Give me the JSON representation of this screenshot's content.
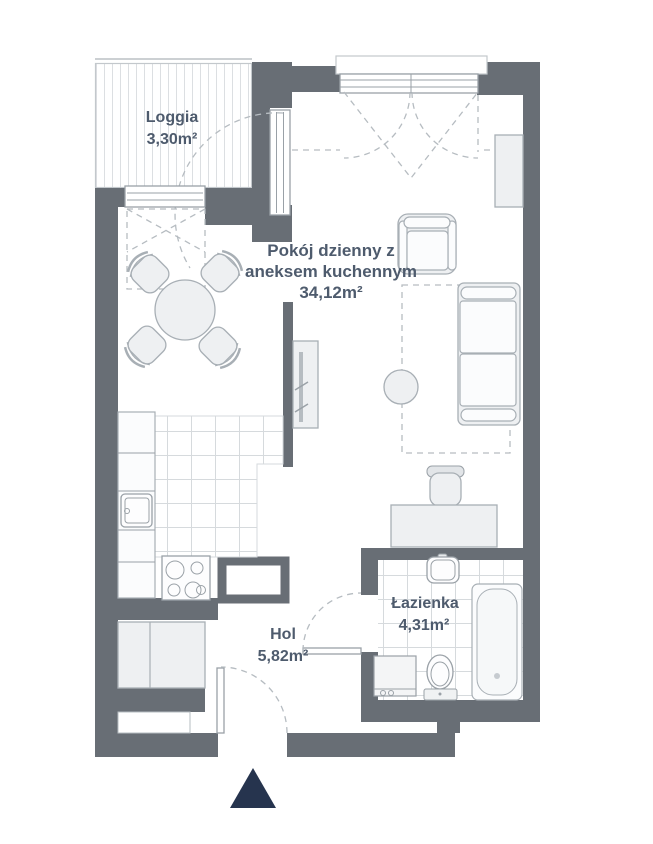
{
  "plan": {
    "rooms": [
      {
        "name": "Loggia",
        "area": "3,30m²"
      },
      {
        "name": "Pokój dzienny z aneksem kuchennym",
        "name_lines": [
          "Pokój dzienny z",
          "aneksem kuchennym"
        ],
        "area": "34,12m²"
      },
      {
        "name": "Hol",
        "area": "5,82m²"
      },
      {
        "name": "Łazienka",
        "area": "4,31m²"
      }
    ],
    "symbols": [
      "dining-table",
      "dining-chair",
      "sofa",
      "armchair",
      "coffee-table",
      "carpet",
      "tv-cabinet",
      "wall-cabinet",
      "desk",
      "desk-chair",
      "kitchen-counter",
      "kitchen-sink",
      "stove",
      "ventilation-shaft",
      "wardrobe",
      "washing-machine",
      "toilet",
      "bathtub",
      "bathroom-sink",
      "window",
      "door-swing",
      "entrance-arrow"
    ],
    "colors": {
      "wall": "#686e75",
      "text": "#4e5b6d",
      "furniture_fill": "#eef0f2",
      "furniture_stroke": "#a8afb5",
      "tile_line": "#d6dadd",
      "dash": "#b6bcc1",
      "stripe": "#dcdfe2",
      "entrance_marker": "#26344e",
      "background": "#ffffff"
    }
  }
}
